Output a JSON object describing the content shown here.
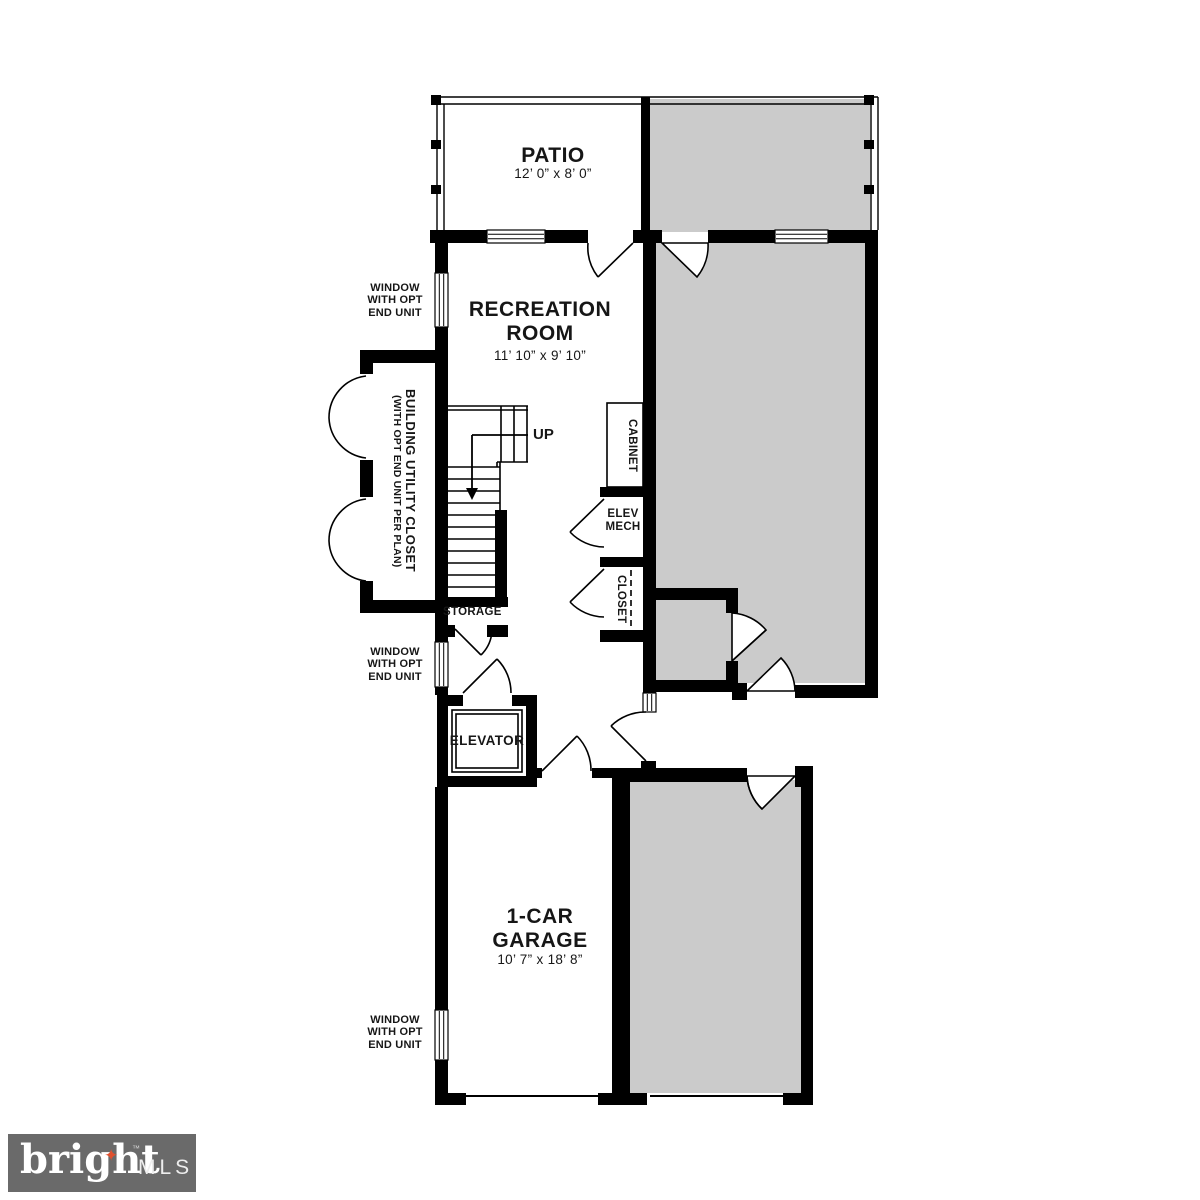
{
  "plan": {
    "patio": {
      "name": "PATIO",
      "dims": "12’ 0” x 8’ 0”"
    },
    "recreation_room": {
      "name": "RECREATION ROOM",
      "dims": "11’ 10” x 9’ 10”"
    },
    "garage": {
      "name": "1-CAR GARAGE",
      "dims": "10’ 7” x 18’ 8”"
    },
    "elevator": {
      "name": "ELEVATOR"
    },
    "storage": {
      "name": "STORAGE"
    },
    "cabinet": {
      "name": "CABINET"
    },
    "elev_mech": {
      "name": "ELEV MECH"
    },
    "closet": {
      "name": "CLOSET"
    },
    "utility_closet": {
      "name": "BUILDING UTILITY CLOSET",
      "note": "(WITH OPT END UNIT PER PLAN)"
    },
    "stairs": {
      "up_label": "UP"
    },
    "window_note": "WINDOW WITH OPT END UNIT"
  },
  "branding": {
    "name": "bright",
    "tm": "™",
    "suffix": "MLS",
    "star_icon": "✦"
  },
  "colors": {
    "wall": "#000000",
    "neighbor_fill": "#cbcbcb",
    "logo_background": "#6a6a6a",
    "logo_star": "#e0502e"
  }
}
